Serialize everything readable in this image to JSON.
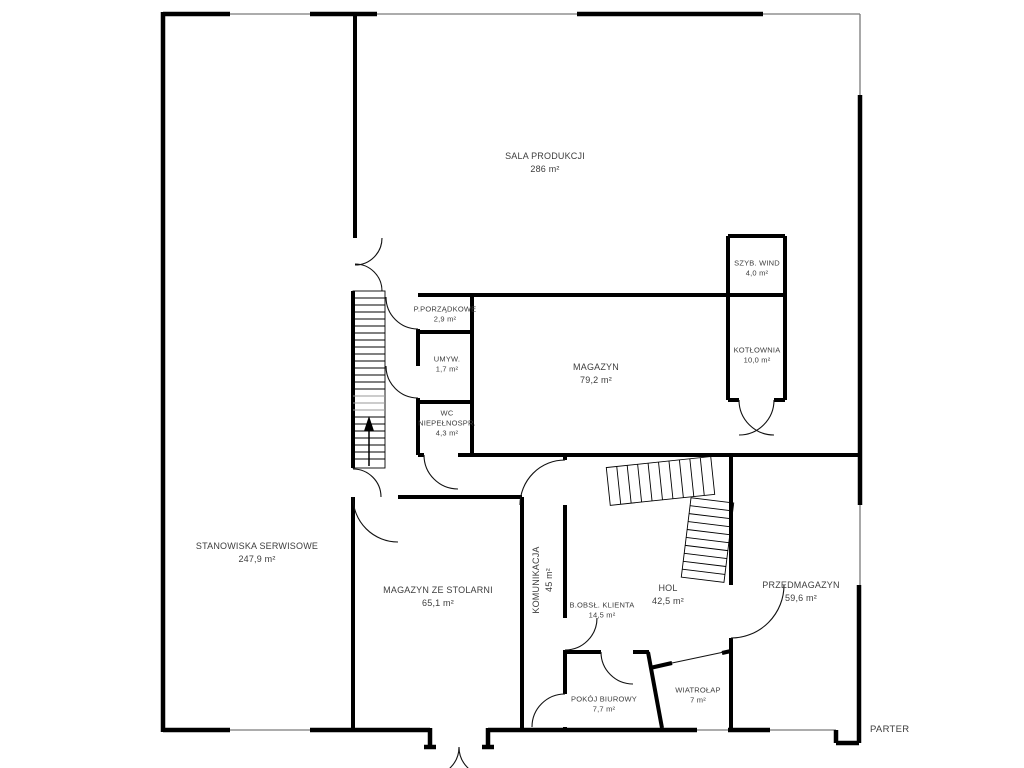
{
  "floor_label": "PARTER",
  "rooms": [
    {
      "name": "SALA PRODUKCJI",
      "area": "286 m²"
    },
    {
      "name": "SZYB. WIND",
      "area": "4,0 m²"
    },
    {
      "name": "KOTŁOWNIA",
      "area": "10,0 m²"
    },
    {
      "name": "P.PORZĄDKOWE",
      "area": "2,9 m²"
    },
    {
      "name": "UMYW.",
      "area": "1,7 m²"
    },
    {
      "name": "WC",
      "subname": "NIEPEŁNOSPR.",
      "area": "4,3 m²"
    },
    {
      "name": "MAGAZYN",
      "area": "79,2 m²"
    },
    {
      "name": "STANOWISKA SERWISOWE",
      "area": "247,9 m²"
    },
    {
      "name": "MAGAZYN ZE STOLARNI",
      "area": "65,1 m²"
    },
    {
      "name": "KOMUNIKACJA",
      "area": "45 m²"
    },
    {
      "name": "B.OBSŁ. KLIENTA",
      "area": "14,5 m²"
    },
    {
      "name": "HOL",
      "area": "42,5 m²"
    },
    {
      "name": "PRZEDMAGAZYN",
      "area": "59,6 m²"
    },
    {
      "name": "POKÓJ BIUROWY",
      "area": "7,7 m²"
    },
    {
      "name": "WIATROŁAP",
      "area": "7 m²"
    }
  ],
  "colors": {
    "wall": "#000000",
    "window": "#7a7a7a",
    "text": "#3d3d3d",
    "background": "#ffffff"
  }
}
